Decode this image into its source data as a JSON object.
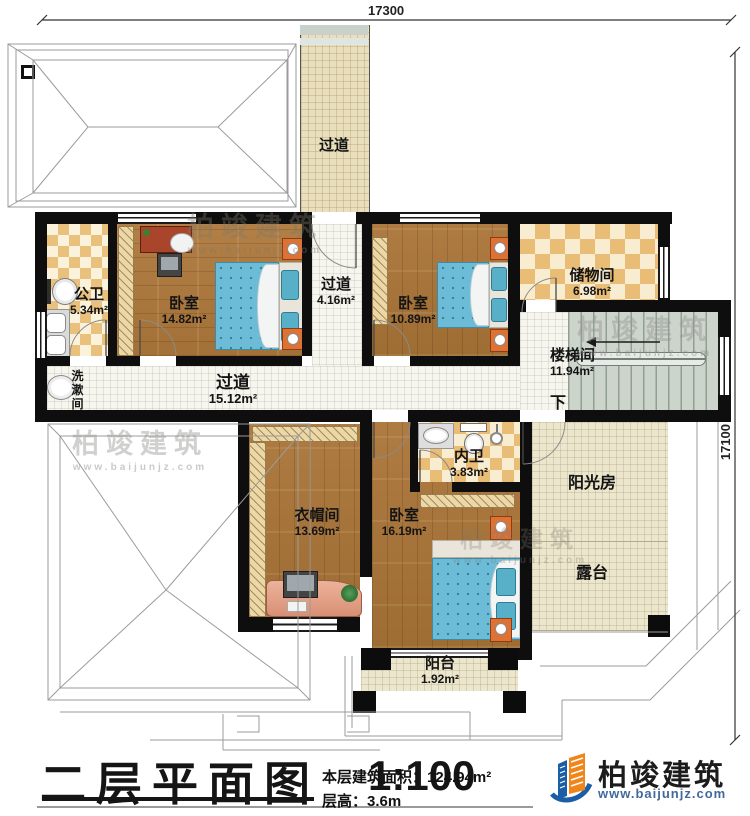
{
  "dimensions": {
    "width": "17300",
    "height": "17100"
  },
  "rooms": [
    {
      "id": "corridor-top",
      "label": "过道",
      "area": ""
    },
    {
      "id": "public-bath",
      "label": "公卫",
      "area": "5.34m²"
    },
    {
      "id": "bedroom-1",
      "label": "卧室",
      "area": "14.82m²"
    },
    {
      "id": "corridor-mid",
      "label": "过道",
      "area": "4.16m²"
    },
    {
      "id": "bedroom-2",
      "label": "卧室",
      "area": "10.89m²"
    },
    {
      "id": "storage-room",
      "label": "储物间",
      "area": "6.98m²"
    },
    {
      "id": "stairwell",
      "label": "楼梯间",
      "area": "11.94m²"
    },
    {
      "id": "washroom",
      "label": "洗漱间",
      "area": ""
    },
    {
      "id": "corridor-main",
      "label": "过道",
      "area": "15.12m²"
    },
    {
      "id": "cloakroom",
      "label": "衣帽间",
      "area": "13.69m²"
    },
    {
      "id": "ensuite-bath",
      "label": "内卫",
      "area": "3.83m²"
    },
    {
      "id": "bedroom-3",
      "label": "卧室",
      "area": "16.19m²"
    },
    {
      "id": "sunroom",
      "label": "阳光房",
      "area": ""
    },
    {
      "id": "terrace",
      "label": "露台",
      "area": ""
    },
    {
      "id": "balcony",
      "label": "阳台",
      "area": "1.92m²"
    }
  ],
  "stairs": {
    "down_label": "下"
  },
  "title_block": {
    "plan_name": "二层平面图",
    "scale": "1:100",
    "area_label": "本层建筑面积：",
    "area_value": "124.94m²",
    "floor_height_label": "层高：",
    "floor_height_value": "3.6m"
  },
  "brand": {
    "name": "柏竣建筑",
    "site": "www.baijunjz.com"
  },
  "watermark": {
    "text": "柏竣建筑",
    "site": "www.baijunjz.com"
  }
}
